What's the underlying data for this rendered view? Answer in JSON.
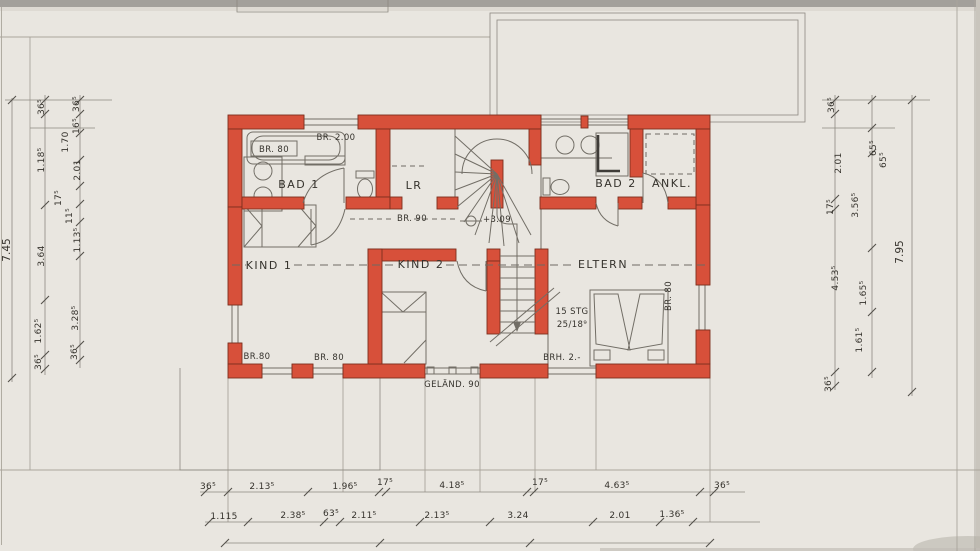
{
  "rooms": {
    "bad1": "BAD 1",
    "lr": "LR",
    "bad2": "BAD 2",
    "ankl": "ANKL.",
    "kind1": "KIND 1",
    "kind2": "KIND 2",
    "eltern": "ELTERN"
  },
  "annotations": {
    "tub_width": "BR. 80",
    "north_window": "BR. 2.00",
    "hall_door": "BR. 90",
    "level_mark": "+3.09",
    "stair_line1": "15 STG",
    "stair_line2": "25/18⁹",
    "south_window1": "BR.80",
    "south_window2": "BR. 80",
    "east_window": "BR. 80",
    "railing": "GELÄND. 90",
    "parapet": "BRH. 2.-"
  },
  "dimensions": {
    "left_total": "7.45",
    "right_total": "7.95",
    "left_mid": [
      "36⁵",
      "1.18⁵",
      "3.64",
      "1.62⁵",
      "36⁵"
    ],
    "left_inner": [
      "36⁵",
      "16⁵",
      "1.70",
      "2.01",
      "17⁵",
      "11⁵",
      "1.13⁵",
      "3.28⁵",
      "36⁵"
    ],
    "right_inner": [
      "36⁵",
      "2.01",
      "17⁵",
      "4.53⁵",
      "36⁵"
    ],
    "right_mid": [
      "65⁵",
      "65⁵",
      "3.56⁵",
      "1.65⁵",
      "1.61⁵"
    ],
    "bottom_row1": [
      "36⁵",
      "2.13⁵",
      "1.96⁵",
      "17⁵",
      "4.18⁵",
      "17⁵",
      "4.63⁵",
      "36⁵"
    ],
    "bottom_row2": [
      "1.115",
      "2.38⁵",
      "63⁵",
      "2.11⁵",
      "2.13⁵",
      "3.24",
      "2.01",
      "1.36⁵"
    ]
  }
}
